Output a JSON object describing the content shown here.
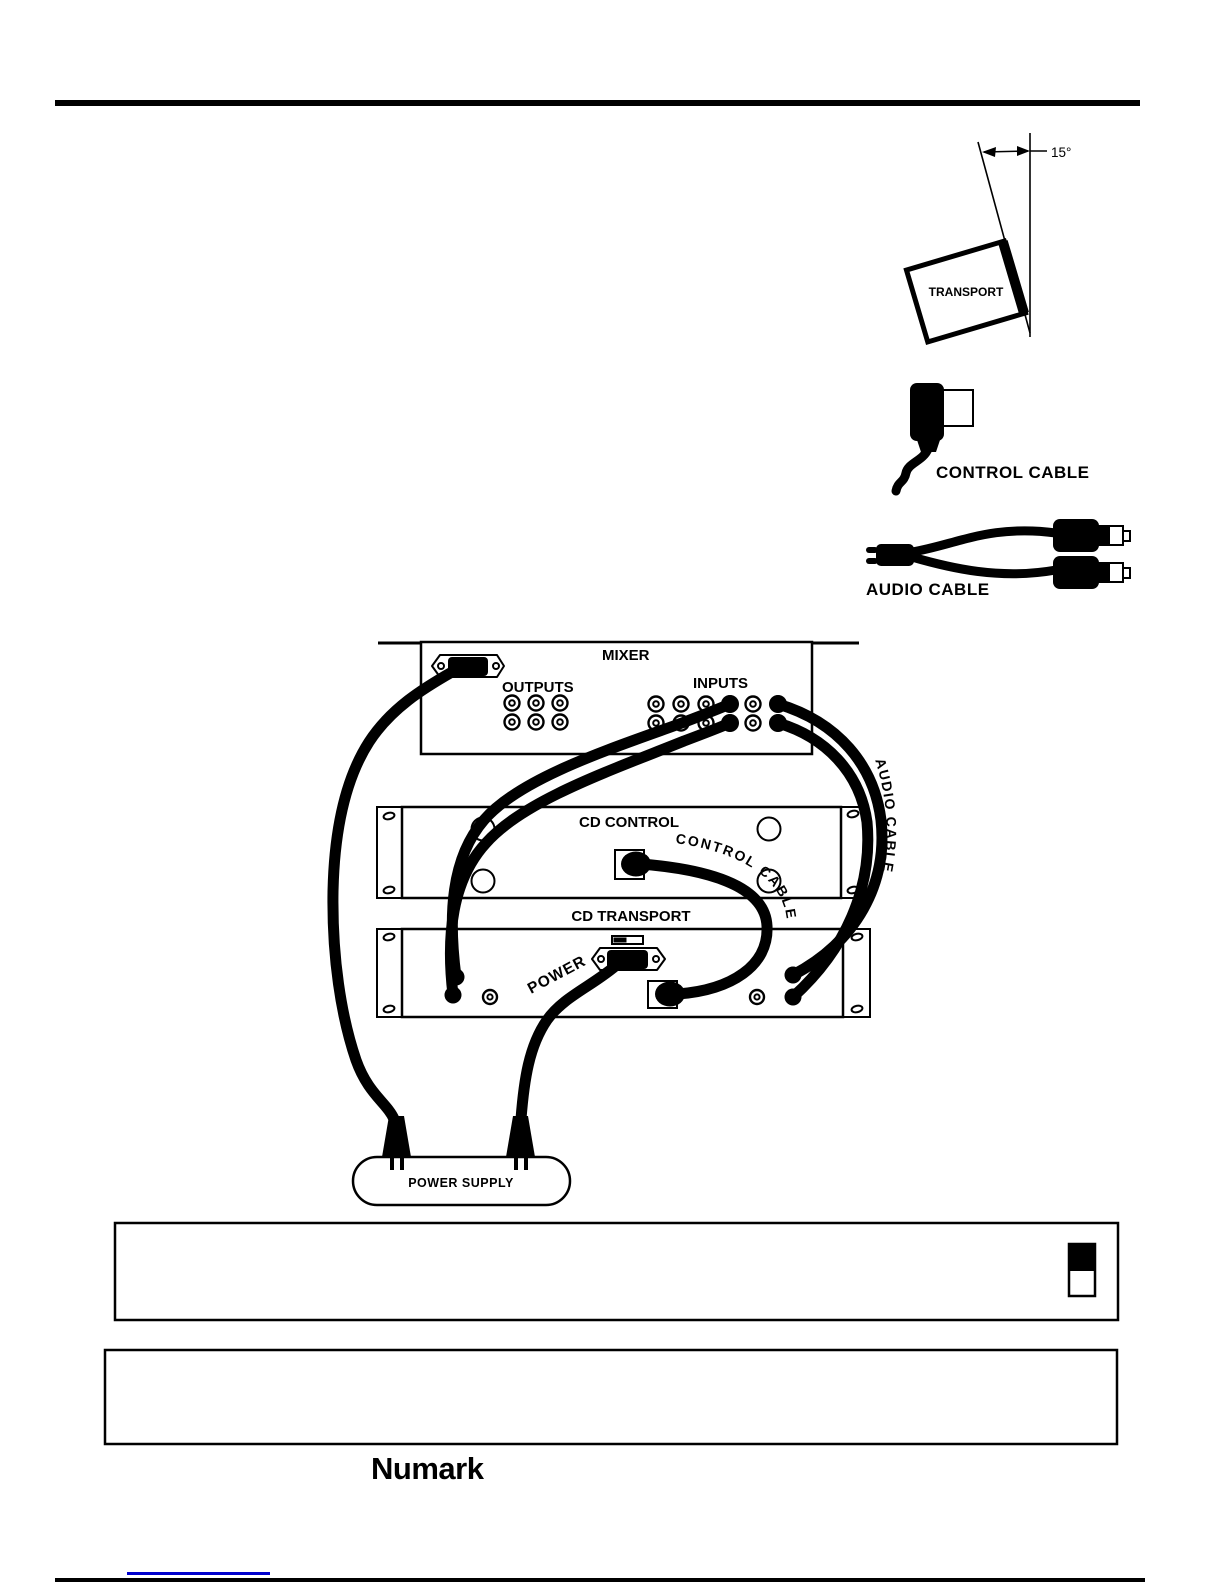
{
  "page": {
    "background": "#ffffff",
    "ink_color": "#000000",
    "link_color": "#0000cd"
  },
  "tilt_diagram": {
    "angle_label": "15°",
    "box_label": "TRANSPORT"
  },
  "cable_legend": {
    "control_cable_label": "CONTROL CABLE",
    "audio_cable_label": "AUDIO CABLE"
  },
  "wiring_diagram": {
    "mixer": {
      "label": "MIXER",
      "outputs_label": "OUTPUTS",
      "inputs_label": "INPUTS",
      "output_jack_count": 6,
      "input_jack_count": 12
    },
    "cd_control": {
      "label": "CD CONTROL"
    },
    "cd_transport": {
      "label": "CD TRANSPORT"
    },
    "power_supply": {
      "label": "POWER SUPPLY"
    },
    "cable_labels": {
      "control_cable": "CONTROL CABLE",
      "audio_cable": "AUDIO CABLE",
      "power": "POWER"
    },
    "connections": [
      {
        "from": "mixer-ac-inlet",
        "to": "power-supply",
        "cable": "power cord"
      },
      {
        "from": "cd-transport-ac-inlet",
        "to": "power-supply",
        "cable": "POWER"
      },
      {
        "from": "cd-control-remote-connector",
        "to": "cd-transport-remote-connector",
        "cable": "CONTROL CABLE"
      },
      {
        "from": "cd-transport-left-audio-jacks",
        "to": "mixer-inputs",
        "cable": "audio cable"
      },
      {
        "from": "cd-transport-right-audio-jacks",
        "to": "mixer-inputs",
        "cable": "AUDIO CABLE"
      }
    ]
  },
  "notes": {
    "note_box_1": {
      "text": "",
      "has_power_switch_icon": true
    },
    "note_box_2": {
      "text": ""
    }
  },
  "footer": {
    "brand": "Numark"
  }
}
